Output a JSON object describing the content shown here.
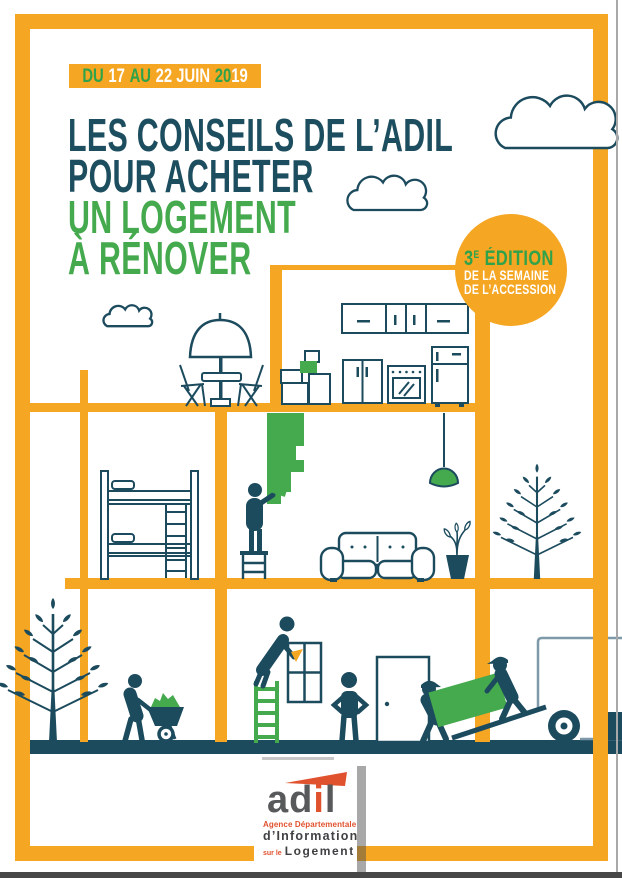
{
  "palette": {
    "orange": "#F5A623",
    "teal": "#1C4B5E",
    "green": "#45A94E",
    "badge_text_green": "#2FA24A",
    "truck_outline": "#7E99A8",
    "logo_red": "#E0512D",
    "logo_gray": "#58595B"
  },
  "date_badge": {
    "seg1": "DU",
    "seg2": "17",
    "seg3": "AU",
    "seg4": "22 JUIN",
    "seg5": "20",
    "seg6": "19"
  },
  "title": {
    "line1": "LES CONSEILS DE L’ADIL",
    "line2": "POUR ACHETER",
    "line3": "UN LOGEMENT",
    "line4": "À RÉNOVER"
  },
  "edition_badge": {
    "number": "3",
    "sup": "E",
    "word": " ÉDITION",
    "line2": "DE LA SEMAINE",
    "line3": "DE L’ACCESSION"
  },
  "logo": {
    "ad": "ad",
    "i": "i",
    "l": "l",
    "line1": "Agence Départementale",
    "line2": "d’Information",
    "line3_small": "sur le",
    "line3_big": "Logement"
  }
}
